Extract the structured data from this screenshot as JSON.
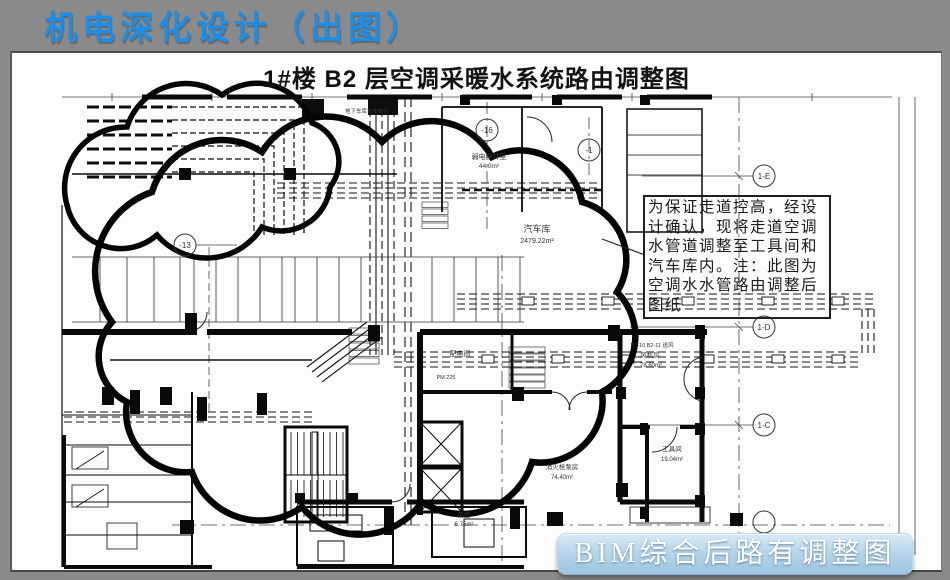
{
  "slide": {
    "title": "机电深化设计（出图）"
  },
  "drawing": {
    "title": "1#楼 B2 层空调采暖水系统路由调整图",
    "annotation_lines": [
      "为保证走道控高，经设",
      "计确认，现将走道空调",
      "水管道调整至工具间和",
      "汽车库内。注：此图为",
      "空调水水管路由调整后",
      "图纸"
    ],
    "grid_bubbles": [
      "-16",
      "-1",
      "-13",
      "1-E",
      "1-D",
      "1-C"
    ],
    "labels": {
      "garage": {
        "name": "汽车库",
        "area": "2479.22m²"
      },
      "weak_power": {
        "name": "弱电电井室",
        "area": "44.0m²"
      },
      "power_room": {
        "name": "配电间",
        "code": "PM.225"
      },
      "fan_room": {
        "tag": "B2-10 B2-11 送风",
        "name": "风机房",
        "area": "78.60m²"
      },
      "tool_room": {
        "name": "工具间",
        "area": "19.04m²"
      },
      "pump_room": {
        "name": "消火栓泵房",
        "area": "74.40m²"
      },
      "front_room": {
        "name": "前室",
        "area": "6.75m²"
      },
      "charging": "地下车库充电桩区",
      "supply_air": "B2-10 B2-1 送风"
    }
  },
  "caption": {
    "label": "BIM综合后路有调整图"
  },
  "colors": {
    "title_blue": "#1a8ee8",
    "slide_background": "#8a8a8a",
    "caption_background": "#b7d6ea",
    "caption_text": "#ffffff",
    "linework": "#111111"
  }
}
